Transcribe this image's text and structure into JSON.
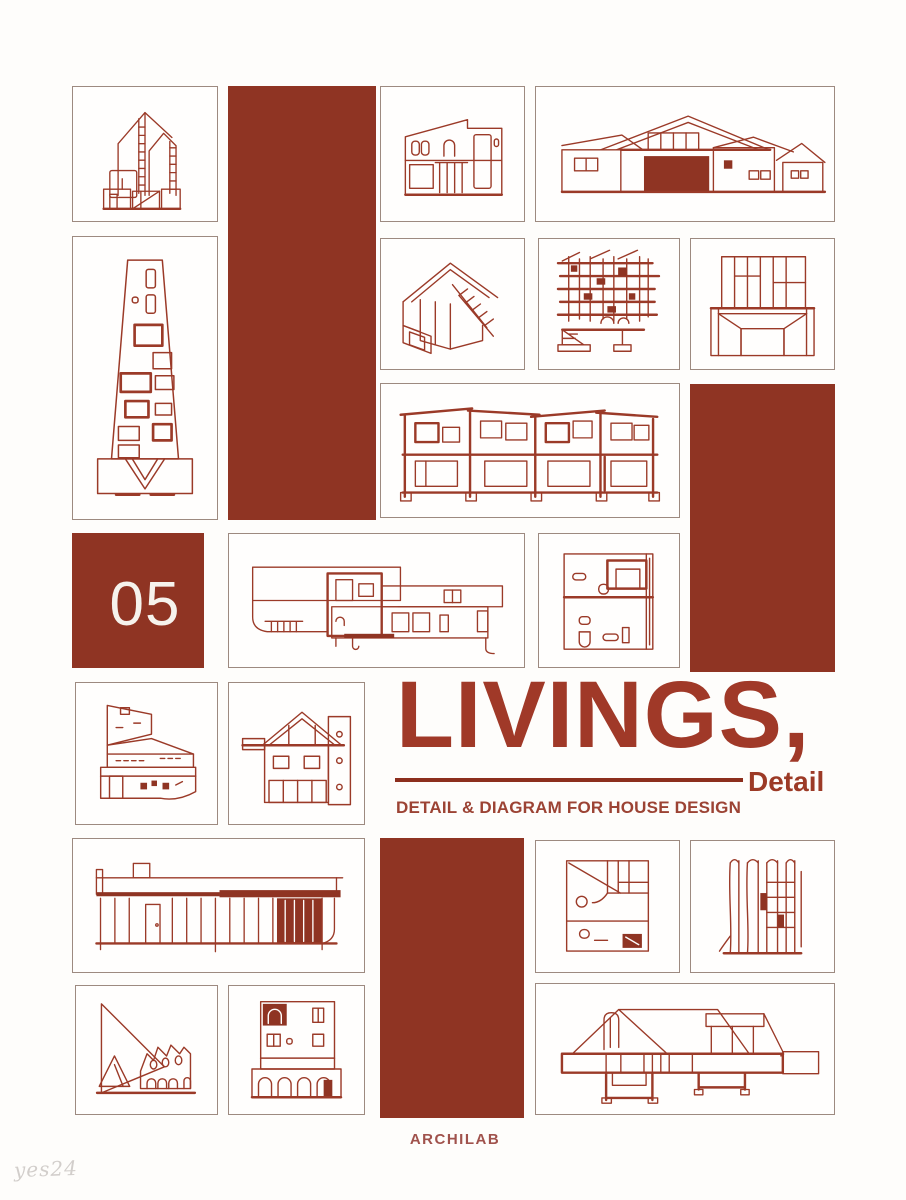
{
  "cover": {
    "badge_number": "05",
    "title": "LIVINGS,",
    "title_accent": "Detail",
    "subtitle": "DETAIL & DIAGRAM FOR HOUSE DESIGN",
    "publisher": "ARCHILAB",
    "watermark": "yes24",
    "colors": {
      "block_red": "#8f3423",
      "drawing_line_red": "#9b3a28",
      "title_red": "#a03928",
      "rule_red": "#8c2e1d",
      "publisher_red": "#a0524c",
      "cell_border": "#9d8a80",
      "background": "#fefdfb",
      "watermark_gray": "#d2cecb"
    },
    "drawings": [
      "narrow-house-elevation",
      "modern-house-elevation",
      "ranch-house-elevation",
      "tower-elevation",
      "house-section-axonometric",
      "timber-framing-section",
      "panel-facade-detail",
      "two-story-long-section",
      "modern-villa-section",
      "floor-plan-detail",
      "angular-building-elevation",
      "house-cross-section",
      "long-building-elevation",
      "plan-circle-detail",
      "wall-section-detail",
      "triangle-sail-building",
      "arched-facade-elevation",
      "brick-roof-section"
    ]
  }
}
